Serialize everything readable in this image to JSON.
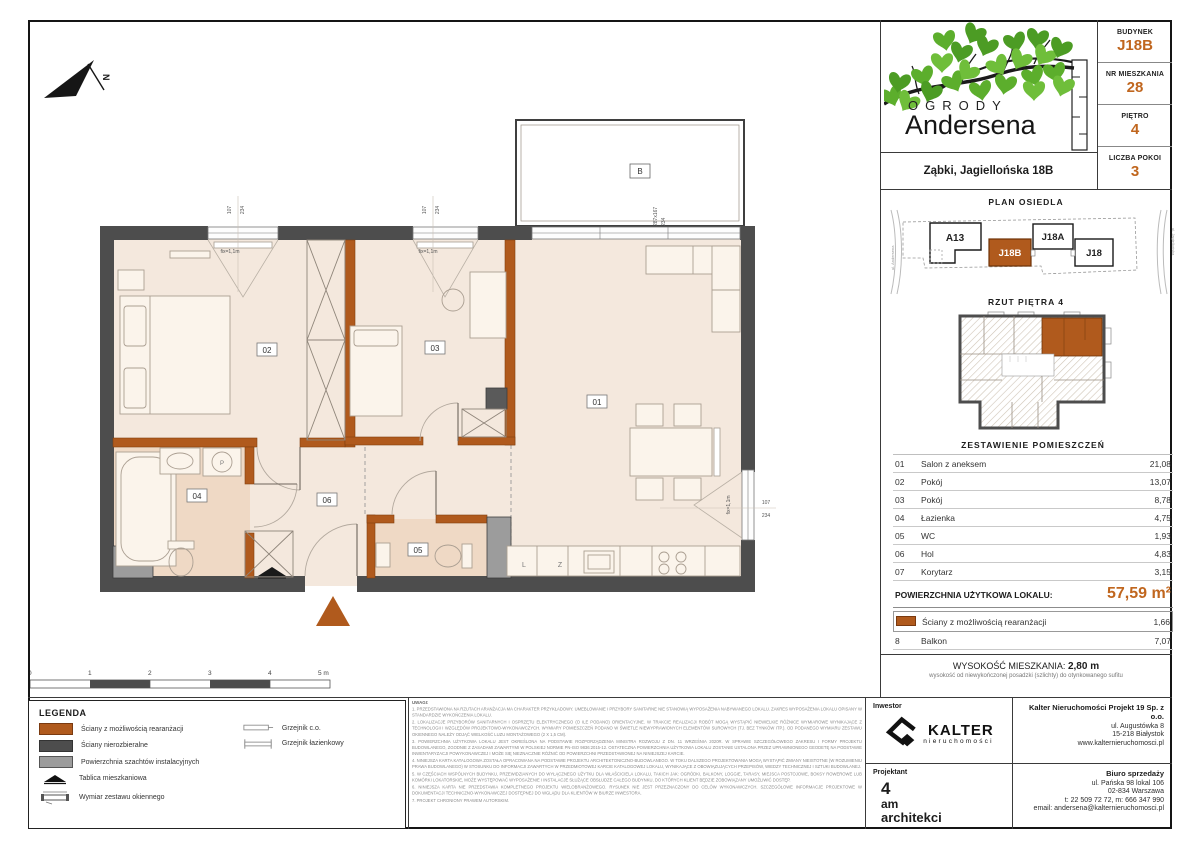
{
  "colors": {
    "accent_orange": "#c0661e",
    "wall_orange": "#b05a1d",
    "wall_dark": "#4d4d4d",
    "shaft_gray": "#9c9c9c",
    "floor": "#f4e8dd",
    "floor_wet": "#efd9c5",
    "leaf_green": "#5cae2c"
  },
  "header": {
    "budynek_label": "BUDYNEK",
    "budynek": "J18B",
    "nr_label": "NR MIESZKANIA",
    "nr": "28",
    "pietro_label": "PIĘTRO",
    "pietro": "4",
    "pokoje_label": "LICZBA POKOI",
    "pokoje": "3"
  },
  "brand": {
    "line1": "OGRODY",
    "line2": "Andersena",
    "address": "Ząbki, Jagiellońska 18B"
  },
  "site_plan": {
    "title": "PLAN OSIEDLA",
    "buildings": [
      {
        "label": "A13"
      },
      {
        "label": "J18B"
      },
      {
        "label": "J18A"
      },
      {
        "label": "J18"
      }
    ],
    "street_left": "ul. Andersena",
    "street_right": "ul. Jagiellońska"
  },
  "floor_thumb": {
    "title": "RZUT PIĘTRA 4"
  },
  "rooms": {
    "title": "ZESTAWIENIE POMIESZCZEŃ",
    "rows": [
      {
        "no": "01",
        "name": "Salon z aneksem",
        "area": "21,08"
      },
      {
        "no": "02",
        "name": "Pokój",
        "area": "13,07"
      },
      {
        "no": "03",
        "name": "Pokój",
        "area": "8,78"
      },
      {
        "no": "04",
        "name": "Łazienka",
        "area": "4,75"
      },
      {
        "no": "05",
        "name": "WC",
        "area": "1,93"
      },
      {
        "no": "06",
        "name": "Hol",
        "area": "4,83"
      },
      {
        "no": "07",
        "name": "Korytarz",
        "area": "3,15"
      }
    ],
    "total_label": "POWIERZCHNIA UŻYTKOWA LOKALU:",
    "total_value": "57,59 m²",
    "rearr": {
      "name": "Ściany z możliwością rearanżacji",
      "area": "1,66"
    },
    "balkon": {
      "no": "8",
      "name": "Balkon",
      "area": "7,07"
    }
  },
  "height_info": {
    "label": "WYSOKOŚĆ MIESZKANIA:",
    "value": "2,80 m",
    "note": "wysokość od niewykończonej posadzki (szlichty) do otynkowanego sufitu"
  },
  "contacts": {
    "inwestor_label": "Inwestor",
    "kalter_name": "KALTER",
    "kalter_sub": "nieruchomości",
    "company": "Kalter Nieruchomości Projekt 19 Sp. z o.o.",
    "company_lines": [
      "ul. Augustówka 8",
      "15-218 Białystok",
      "www.kalternieruchomosci.pl"
    ],
    "projektant_label": "Projektant",
    "architect": [
      "4",
      "am",
      "architekci"
    ],
    "biuro_label": "Biuro sprzedaży",
    "biuro_lines": [
      "ul. Pańska 98 lokal 106",
      "02-834 Warszawa",
      "t: 22 509 72 72, m: 666 347 990",
      "email: andersena@kalternieruchomosci.pl"
    ]
  },
  "legend": {
    "title": "LEGENDA",
    "items": [
      {
        "label": "Ściany z możliwością rearanżacji"
      },
      {
        "label": "Ściany nierozbieralne"
      },
      {
        "label": "Powierzchnia szachtów instalacyjnych"
      },
      {
        "label": "Tablica mieszkaniowa"
      },
      {
        "label": "Wymiar zestawu okiennego"
      },
      {
        "label": "Grzejnik c.o."
      },
      {
        "label": "Grzejnik łazienkowy"
      }
    ]
  },
  "notes": {
    "title": "UWAGI:",
    "items": [
      "1. PRZEDSTAWIONA NA RZUTACH ARANŻACJA MA CHARAKTER PRZYKŁADOWY. UMEBLOWANIE I PRZYBORY SANITARNE NIE STANOWIĄ WYPOSAŻENIA NABYWANEGO LOKALU. ZAKRES WYPOSAŻENIA LOKALU OPISANY W STANDARDZIE WYKOŃCZENIA LOKALU.",
      "2. LOKALIZACJE PRZYBORÓW SANITARNYCH I OSPRZĘTU ELEKTRYCZNEGO (O ILE PODANO) ORIENTACYJNE. W TRAKCIE REALIZACJI ROBÓT MOGĄ WYSTĄPIĆ NIEWIELKIE RÓŻNICE WYMIAROWE WYNIKAJĄCE Z TECHNOLOGII I WZGLĘDÓW PROJEKTOWO-WYKONAWCZYCH. WYMIARY POMIESZCZEŃ PODANO W ŚWIETLE NIEWYPRAWIONYCH ELEMENTÓW SUROWYCH (TJ. BEZ TYNKÓW ITP.). OD PODANEGO WYMIARU ZESTAWU OKIENNEGO NALEŻY ODJĄĆ WIELKOŚĆ LUZU MONTAŻOWEGO (2 X 1,5 CM).",
      "3. POWIERZCHNIA UŻYTKOWA LOKALU JEST OKREŚLONA NA PODSTAWIE ROZPORZĄDZENIA MINISTRA ROZWOJU Z DN. 11 WRZEŚNIA 2020R. W SPRAWIE SZCZEGÓŁOWEGO ZAKRESU I FORMY PROJEKTU BUDOWLANEGO, ZGODNIE Z ZASADAMI ZAWARTYMI W POLSKIEJ NORMIE PN-ISO 9836:2015-12. OSTATECZNA POWIERZCHNIA UŻYTKOWA LOKALU ZOSTANIE USTALONA PRZEZ UPRAWNIONEGO GEODETĘ NA PODSTAWIE INWENTARYZACJI POWYKONAWCZEJ I MOŻE SIĘ NIEZNACZNIE RÓŻNIĆ OD POWIERZCHNI PRZEDSTAWIONEJ NA NINIEJSZEJ KARCIE.",
      "4. NINIEJSZA KARTA KATALOGOWA ZOSTAŁA OPRACOWANA NA PODSTAWIE PROJEKTU ARCHITEKTONICZNO-BUDOWLANEGO. W TOKU DALSZEGO PROJEKTOWANIA MOGĄ WYSTĄPIĆ ZMIANY NIEISTOTNE (W ROZUMIENIU PRAWA BUDOWLANEGO) W STOSUNKU DO INFORMACJI ZAWARTYCH W PRZEDMIOTOWEJ KARCIE KATALOGOWEJ LOKALU, WYNIKAJĄCE Z OBOWIĄZUJĄCYCH PRZEPISÓW, WIEDZY TECHNICZNEJ I SZTUKI BUDOWLANEJ.",
      "5. W CZĘŚCIACH WSPÓLNYCH BUDYNKU, PRZEWIDZIANYCH DO WYŁĄCZNEGO UŻYTKU DLA WŁAŚCICIELA LOKALU, TAKICH JAK: OGRÓDKI, BALKONY, LOGGIE, TARASY, MIEJSCA POSTOJOWE, BOKSY ROWEROWE LUB KOMÓRKI LOKATORSKIE, MOŻE WYSTĘPOWAĆ WYPOSAŻENIE I INSTALACJE SŁUŻĄCE OBSŁUDZE CAŁEGO BUDYNKU, DO KTÓRYCH KLIENT BĘDZIE ZOBOWIĄZANY UMOŻLIWIĆ DOSTĘP.",
      "6. NINIEJSZA KARTA NIE PRZEDSTAWIA KOMPLETNEGO PROJEKTU WIELOBRANŻOWEGO. RYSUNEK NIE JEST PRZEZNACZONY DO CELÓW WYKONAWCZYCH. SZCZEGÓŁOWE INFORMACJE PROJEKTOWE W DOKUMENTACJI TECHNICZNO-WYKONAWCZEJ DOSTĘPNEJ DO WGLĄDU DLA KLIENTÓW W BIURZE INWESTORA.",
      "7. PROJEKT CHRONIONY PRAWEM AUTORSKIM."
    ]
  },
  "scale_bar": {
    "ticks": [
      "0",
      "1",
      "2",
      "3",
      "4",
      "5 m"
    ]
  },
  "plan": {
    "labels": {
      "r01": "01",
      "r02": "02",
      "r03": "03",
      "r04": "04",
      "r05": "05",
      "r06": "06",
      "balcony": "B",
      "north": "N"
    },
    "dims": {
      "w": "107",
      "h": "234",
      "fix": "fix=1,1m",
      "bal_w": "287x167",
      "bal_h": "234"
    },
    "kitchen": {
      "l": "L",
      "z": "Z",
      "p": "P"
    }
  }
}
